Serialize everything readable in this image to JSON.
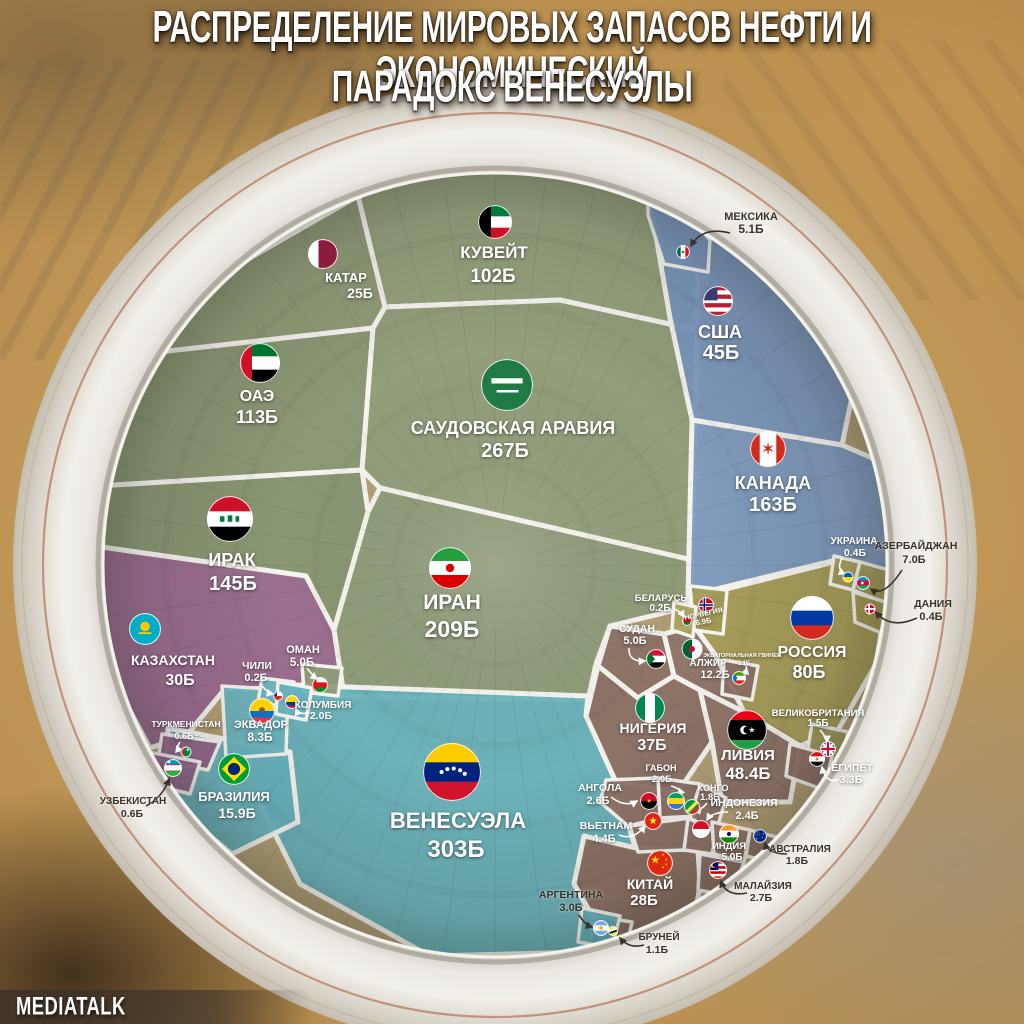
{
  "title": {
    "line1": "РАСПРЕДЕЛЕНИЕ МИРОВЫХ ЗАПАСОВ НЕФТИ И ЭКОНОМИЧЕСКИЙ",
    "line2": "ПАРАДОКС ВЕНЕСУЭЛЫ"
  },
  "footer": {
    "brand": "MEDIATALK"
  },
  "chart_data": {
    "type": "voronoi-treemap",
    "title": "Распределение мировых запасов нефти и экономический парадокс Венесуэлы",
    "unit": "Б",
    "legend_position": "none",
    "groups": [
      {
        "id": "middle-east",
        "color": "#8f9c79"
      },
      {
        "id": "north-america",
        "color": "#7e9ac2"
      },
      {
        "id": "europe",
        "color": "#a59b58"
      },
      {
        "id": "africa-asia",
        "color": "#8c7167"
      },
      {
        "id": "south-america",
        "color": "#68b2bd"
      },
      {
        "id": "central-asia",
        "color": "#9a6b90"
      }
    ],
    "countries": [
      {
        "id": "venezuela",
        "name": "ВЕНЕСУЭЛА",
        "value": "303Б",
        "group": "south-america"
      },
      {
        "id": "saudi_arabia",
        "name": "САУДОВСКАЯ АРАВИЯ",
        "value": "267Б",
        "group": "middle-east"
      },
      {
        "id": "iran",
        "name": "ИРАН",
        "value": "209Б",
        "group": "middle-east"
      },
      {
        "id": "canada",
        "name": "КАНАДА",
        "value": "163Б",
        "group": "north-america"
      },
      {
        "id": "iraq",
        "name": "ИРАК",
        "value": "145Б",
        "group": "middle-east"
      },
      {
        "id": "uae",
        "name": "ОАЭ",
        "value": "113Б",
        "group": "middle-east"
      },
      {
        "id": "kuwait",
        "name": "КУВЕЙТ",
        "value": "102Б",
        "group": "middle-east"
      },
      {
        "id": "russia",
        "name": "РОССИЯ",
        "value": "80Б",
        "group": "europe"
      },
      {
        "id": "libya",
        "name": "ЛИВИЯ",
        "value": "48.4Б",
        "group": "africa-asia"
      },
      {
        "id": "usa",
        "name": "США",
        "value": "45Б",
        "group": "north-america"
      },
      {
        "id": "nigeria",
        "name": "НИГЕРИЯ",
        "value": "37Б",
        "group": "africa-asia"
      },
      {
        "id": "kazakhstan",
        "name": "КАЗАХСТАН",
        "value": "30Б",
        "group": "central-asia"
      },
      {
        "id": "china",
        "name": "КИТАЙ",
        "value": "28Б",
        "group": "africa-asia"
      },
      {
        "id": "qatar",
        "name": "КАТАР",
        "value": "25Б",
        "group": "middle-east"
      },
      {
        "id": "brazil",
        "name": "БРАЗИЛИЯ",
        "value": "15.9Б",
        "group": "south-america"
      },
      {
        "id": "algeria",
        "name": "АЛЖИР",
        "value": "12.2Б",
        "group": "africa-asia"
      },
      {
        "id": "ecuador",
        "name": "ЭКВАДОР",
        "value": "8.3Б",
        "group": "south-america"
      },
      {
        "id": "azerbaijan",
        "name": "АЗЕРБАЙДЖАН",
        "value": "7.0Б",
        "group": "europe"
      },
      {
        "id": "norway",
        "name": "НОРВЕГИЯ",
        "value": "6.9Б",
        "group": "europe"
      },
      {
        "id": "mexico",
        "name": "МЕКСИКА",
        "value": "5.1Б",
        "group": "north-america"
      },
      {
        "id": "sudan",
        "name": "СУДАН",
        "value": "5.0Б",
        "group": "africa-asia"
      },
      {
        "id": "oman",
        "name": "ОМАН",
        "value": "5.0Б",
        "group": "middle-east"
      },
      {
        "id": "india",
        "name": "ИНДИЯ",
        "value": "5.0Б",
        "group": "africa-asia"
      },
      {
        "id": "vietnam",
        "name": "ВЬЕТНАМ",
        "value": "4.4Б",
        "group": "africa-asia"
      },
      {
        "id": "egypt",
        "name": "ЕГИПЕТ",
        "value": "3.3Б",
        "group": "africa-asia"
      },
      {
        "id": "argentina",
        "name": "АРГЕНТИНА",
        "value": "3.0Б",
        "group": "south-america"
      },
      {
        "id": "malaysia",
        "name": "МАЛАЙЗИЯ",
        "value": "2.7Б",
        "group": "africa-asia"
      },
      {
        "id": "angola",
        "name": "АНГОЛА",
        "value": "2.6Б",
        "group": "africa-asia"
      },
      {
        "id": "indonesia",
        "name": "ИНДОНЕЗИЯ",
        "value": "2.4Б",
        "group": "africa-asia"
      },
      {
        "id": "gabon",
        "name": "ГАБОН",
        "value": "2.0Б",
        "group": "africa-asia"
      },
      {
        "id": "colombia",
        "name": "КОЛУМБИЯ",
        "value": "2.0Б",
        "group": "south-america"
      },
      {
        "id": "congo",
        "name": "КОНГО",
        "value": "1.8Б",
        "group": "africa-asia"
      },
      {
        "id": "australia",
        "name": "АВСТРАЛИЯ",
        "value": "1.8Б",
        "group": "africa-asia"
      },
      {
        "id": "uk",
        "name": "ВЕЛИКОБРИТАНИЯ",
        "value": "1.5Б",
        "group": "europe"
      },
      {
        "id": "equatorial_guinea",
        "name": "ЭКВАТОРИАЛЬНАЯ ГВИНЕЯ",
        "value": "1.1Б",
        "group": "africa-asia"
      },
      {
        "id": "brunei",
        "name": "БРУНЕЙ",
        "value": "1.1Б",
        "group": "africa-asia"
      },
      {
        "id": "turkmenistan",
        "name": "ТУРКМЕНИСТАН",
        "value": "0.6Б",
        "group": "central-asia"
      },
      {
        "id": "uzbekistan",
        "name": "УЗБЕКИСТАН",
        "value": "0.6Б",
        "group": "central-asia"
      },
      {
        "id": "ukraine",
        "name": "УКРАИНА",
        "value": "0.4Б",
        "group": "europe"
      },
      {
        "id": "denmark",
        "name": "ДАНИЯ",
        "value": "0.4Б",
        "group": "europe"
      },
      {
        "id": "belarus",
        "name": "БЕЛАРУСЬ",
        "value": "0.2Б",
        "group": "europe"
      },
      {
        "id": "chile",
        "name": "ЧИЛИ",
        "value": "0.2Б",
        "group": "south-america"
      }
    ]
  }
}
